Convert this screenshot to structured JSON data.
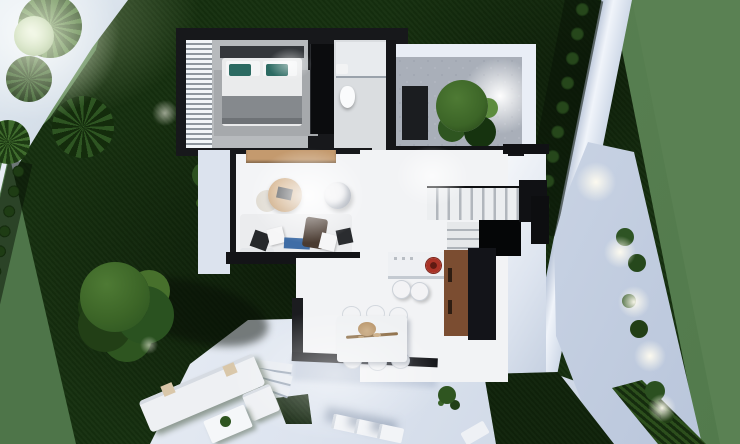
{
  "scene": {
    "kind": "3d-aerial-floorplan-render",
    "subject": "modern-villa-with-garden",
    "time_of_day": "dusk",
    "canvas_px": {
      "width": 740,
      "height": 444
    }
  },
  "colors": {
    "sage": "#5a8153",
    "lawn": "#16300f",
    "lawnShadow": "#0a1c06",
    "pathLight": "#b9c7d8",
    "pavement": "#e3e9f1",
    "wallWhite": "#eef3f9",
    "houseWall": "#17181b",
    "floorWhite": "#f3f4f6",
    "floorGray": "#b7babd",
    "rugGray": "#a6a9ac",
    "woodSideboard": "#c49a6e",
    "woodCabinet": "#7b4d31",
    "sofaWhite": "#ebecee",
    "pillowTeal": "#2c6a62",
    "pillowBlue": "#3f6da6",
    "throwBrown": "#4a3b31",
    "cooktopRed": "#a93226",
    "treeGreen": "#3c6527",
    "treeDark": "#1d3a13",
    "bushDark": "#122a0c",
    "glowWhite": "#ffffff"
  },
  "garden": {
    "left_fence_bush_count": 14,
    "right_wall_bush_count": 9,
    "walkway_light_count": 5,
    "walkway_plant_count": 6,
    "palm_count": 4,
    "big_tree_count": 1,
    "courtyard_tree_count": 1,
    "lounger_count": 4
  },
  "rooms": [
    {
      "id": "bedroom",
      "furniture": [
        "double-bed",
        "teal-pillows",
        "gray-blanket",
        "rug",
        "louvered-shutters",
        "wardrobe"
      ]
    },
    {
      "id": "bathroom",
      "furniture": [
        "shower",
        "toilet",
        "sink"
      ]
    },
    {
      "id": "courtyard",
      "furniture": [
        "gravel-floor",
        "tree",
        "planter",
        "spot-light"
      ]
    },
    {
      "id": "living-room",
      "furniture": [
        "sofa",
        "pillows",
        "round-coffee-table",
        "side-table",
        "armchair",
        "wood-sideboard"
      ]
    },
    {
      "id": "dining-area",
      "furniture": [
        "dining-table",
        "centerpiece"
      ],
      "chair_count": 6
    },
    {
      "id": "kitchen",
      "furniture": [
        "island",
        "red-cooktop",
        "bar-stools",
        "tall-wood-cabinet"
      ],
      "stool_count": 2
    },
    {
      "id": "staircase",
      "furniture": [
        "upper-flight",
        "landing",
        "stairwell-void"
      ]
    },
    {
      "id": "terrace",
      "furniture": [
        "outdoor-sofa",
        "outdoor-armchair",
        "outdoor-coffee-table",
        "sun-loungers",
        "steps"
      ]
    }
  ]
}
